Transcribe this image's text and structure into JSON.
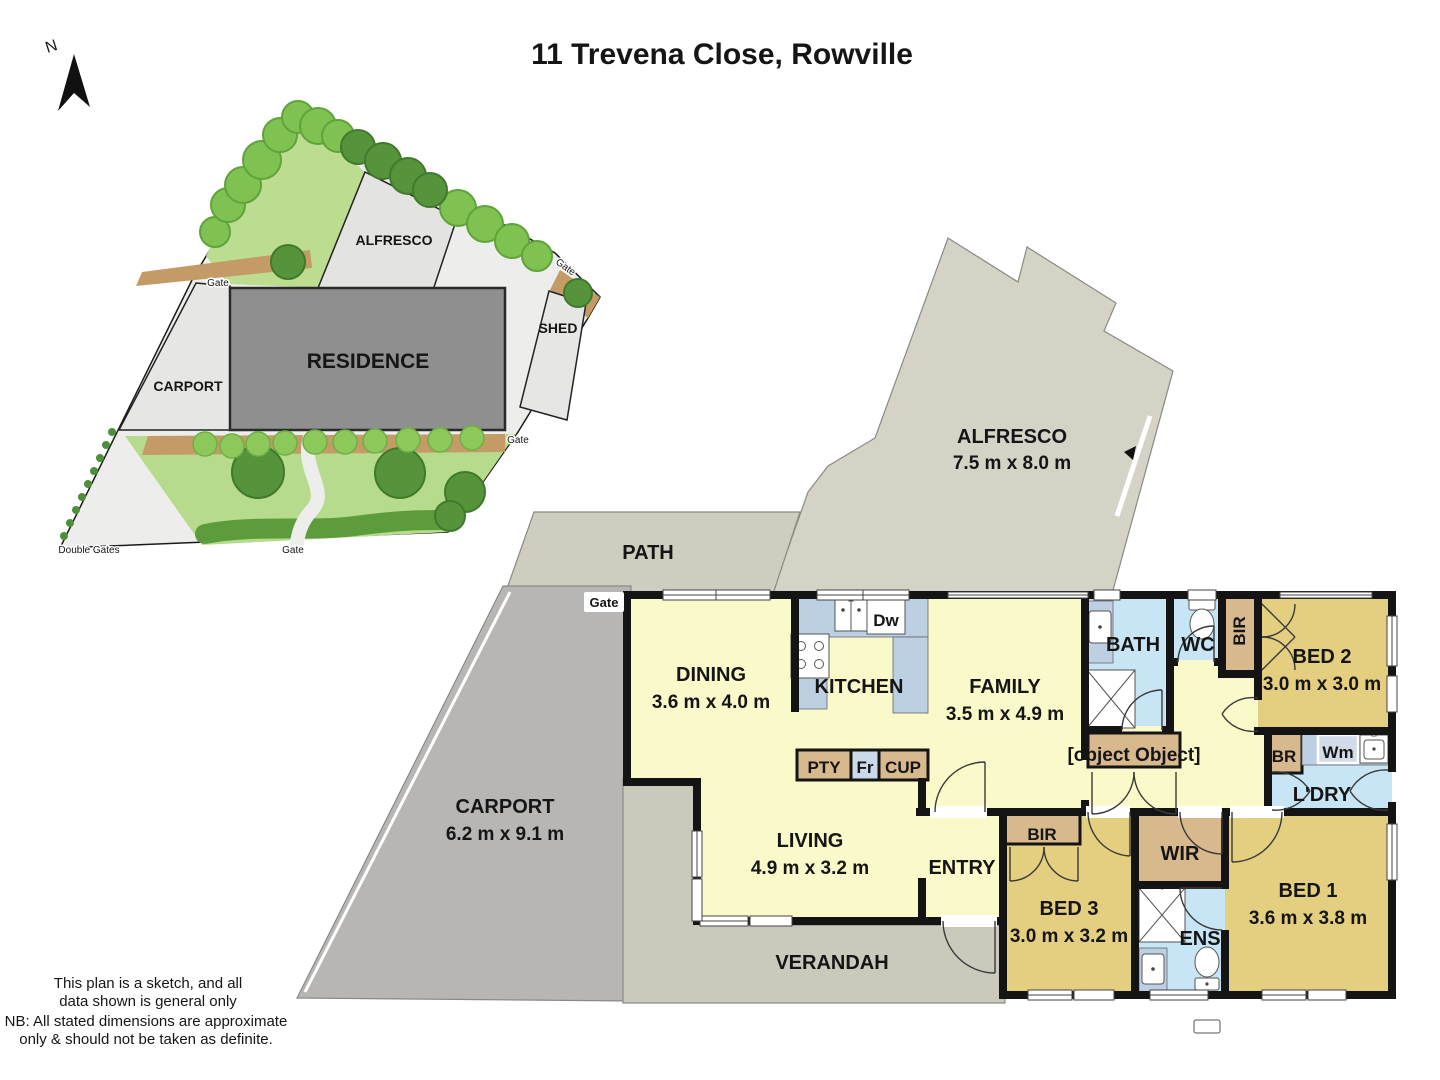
{
  "title": "11 Trevena Close, Rowville",
  "compass": {
    "north_label": "N"
  },
  "site_plan": {
    "alfresco": "ALFRESCO",
    "residence": "RESIDENCE",
    "carport": "CARPORT",
    "shed": "SHED",
    "gate_top": "Gate",
    "gate_upper_right": "Gate",
    "gate_right": "Gate",
    "gate_bottom": "Gate",
    "double_gates": "Double Gates"
  },
  "floor_plan": {
    "gate": "Gate",
    "alfresco": {
      "name": "ALFRESCO",
      "dims": "7.5 m x 8.0 m"
    },
    "path": {
      "name": "PATH"
    },
    "carport": {
      "name": "CARPORT",
      "dims": "6.2 m x 9.1 m"
    },
    "verandah": {
      "name": "VERANDAH"
    },
    "dining": {
      "name": "DINING",
      "dims": "3.6 m x 4.0 m"
    },
    "kitchen": {
      "name": "KITCHEN"
    },
    "family": {
      "name": "FAMILY",
      "dims": "3.5 m x 4.9 m"
    },
    "living": {
      "name": "LIVING",
      "dims": "4.9 m x 3.2 m"
    },
    "entry": {
      "name": "ENTRY"
    },
    "bath": {
      "name": "BATH"
    },
    "wc": {
      "name": "WC"
    },
    "linen": {
      "name": "LINEN"
    },
    "ldry": {
      "name": "L'DRY"
    },
    "bed1": {
      "name": "BED 1",
      "dims": "3.6 m x 3.8 m"
    },
    "bed2": {
      "name": "BED 2",
      "dims": "3.0 m x 3.0 m"
    },
    "bed3": {
      "name": "BED 3",
      "dims": "3.0 m x 3.2 m"
    },
    "wir": {
      "name": "WIR"
    },
    "ens": {
      "name": "ENS"
    },
    "bir_bed2": "BIR",
    "bir_bed3": "BIR",
    "br": "BR",
    "wm": "Wm",
    "dw": "Dw",
    "pty": "PTY",
    "fr": "Fr",
    "cup": "CUP"
  },
  "disclaimer": {
    "line1": "This plan is a sketch, and all",
    "line2": "data shown is general only",
    "line3": "NB: All stated dimensions are approximate",
    "line4": "only & should not be taken as definite."
  },
  "colors": {
    "wall": "#141414",
    "room_yellow": "#FAF9C9",
    "bedroom_gold": "#E4CE80",
    "wet_area_blue": "#C7E5F5",
    "bench_blue": "#BCCFE3",
    "joinery_tan": "#D8B88D",
    "carport_grey": "#B7B6B4",
    "outdoor_beige": "#D5D2C6",
    "verandah_grey": "#CBC8BC",
    "lawn_green": "#BCDD90",
    "tree_green": "#5D9C3C",
    "dirt_tan": "#C49A66",
    "residence_grey": "#8F8F8F"
  }
}
